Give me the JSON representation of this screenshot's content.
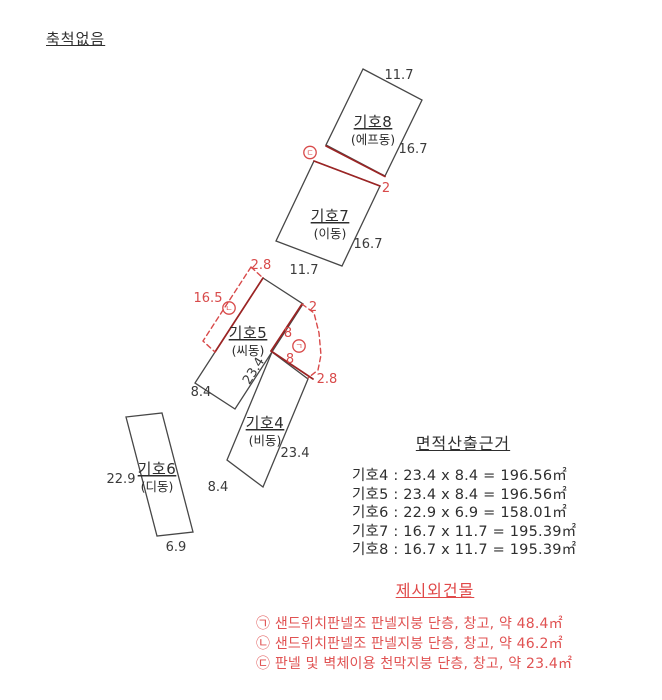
{
  "scale_note": "축척없음",
  "plan": {
    "colors": {
      "outline": "#474747",
      "red_dashed": "#d84a4a",
      "red_solid": "#9c2424"
    },
    "buildings": {
      "b8": {
        "name": "기호8",
        "alias": "(에프동)",
        "dim_top": "11.7",
        "dim_right": "16.7"
      },
      "b7": {
        "name": "기호7",
        "alias": "(이동)",
        "dim_right": "16.7",
        "dim_bottom": "11.7"
      },
      "b5": {
        "name": "기호5",
        "alias": "(씨동)",
        "dim_side": "23.4",
        "dim_bottom": "8.4"
      },
      "b4": {
        "name": "기호4",
        "alias": "(비동)",
        "dim_side": "23.4",
        "dim_bottom": "8.4"
      },
      "b6": {
        "name": "기호6",
        "alias": "(디동)",
        "dim_left": "22.9",
        "dim_bottom": "6.9"
      }
    },
    "annotations": {
      "mark_a": "ㄱ",
      "mark_b": "ㄴ",
      "mark_c": "ㄷ",
      "gap_78_width": "2",
      "annex_b_top": "2.8",
      "annex_b_length": "16.5",
      "annex_a_top": "2",
      "annex_a_seg1": "8",
      "annex_a_seg2": "8",
      "annex_a_bottom": "2.8"
    }
  },
  "area_section": {
    "title": "면적산출근거",
    "rows": [
      "기호4 : 23.4 x 8.4 = 196.56㎡",
      "기호5 : 23.4 x 8.4 = 196.56㎡",
      "기호6 : 22.9 x 6.9 = 158.01㎡",
      "기호7 : 16.7 x 11.7 = 195.39㎡",
      "기호8 : 16.7 x 11.7 = 195.39㎡"
    ]
  },
  "extra_section": {
    "title": "제시외건물",
    "rows": [
      "㉠ 샌드위치판넬조 판넬지붕 단층, 창고, 약 48.4㎡",
      "㉡ 샌드위치판넬조 판넬지붕 단층, 창고, 약 46.2㎡",
      "㉢ 판넬 및 벽체이용 천막지붕 단층, 창고, 약 23.4㎡"
    ]
  }
}
